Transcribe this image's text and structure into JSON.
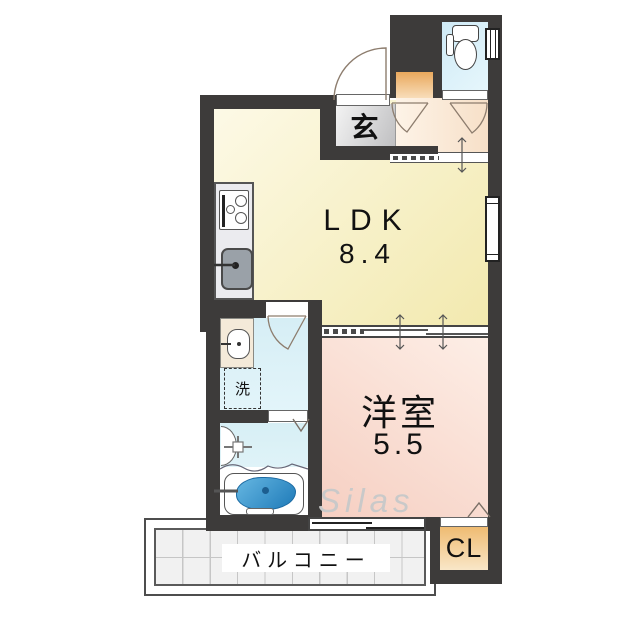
{
  "plan": {
    "rooms": {
      "ldk": {
        "label": "LDK",
        "size": "8.4"
      },
      "western": {
        "label": "洋室",
        "size": "5.5"
      },
      "entrance": {
        "label": "玄"
      },
      "laundry": {
        "label": "洗"
      },
      "closet": {
        "label": "CL"
      },
      "balcony": {
        "label": "バルコニー"
      }
    },
    "watermark": "Silas",
    "colors": {
      "wall": "#3d3b3a",
      "ldk_floor": "#f6efbe",
      "western_floor": "#f9d9cc",
      "hall_floor": "#fae6cf",
      "entrance_floor": "#d9d9db",
      "wet_area_floor": "#d9f0f6",
      "toilet_floor": "#d6eef8",
      "closet_floor": "#f3c27e",
      "shoe_cabinet": "#eba95e",
      "bath_water": "#2e86c4",
      "balcony_tile": "#f1f1f1"
    },
    "icons": {
      "toilet": "toilet-icon",
      "stove": "stove-icon",
      "kitchen_sink": "kitchen-sink-icon",
      "washbasin": "washbasin-icon",
      "bathtub": "bathtub-icon",
      "shower": "shower-valve-icon"
    }
  }
}
